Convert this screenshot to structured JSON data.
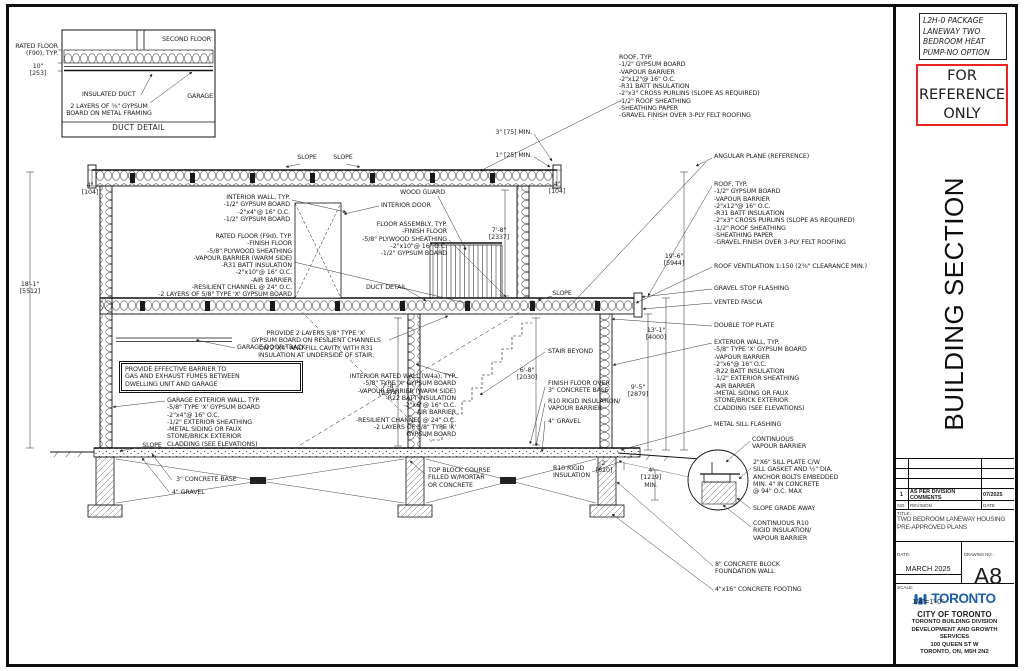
{
  "panel": {
    "package_lines": [
      "L2H-0 PACKAGE",
      "LANEWAY TWO",
      "BEDROOM HEAT",
      "PUMP-NO OPTION"
    ],
    "reference_lines": [
      "FOR",
      "REFERENCE",
      "ONLY"
    ],
    "section_title": "BUILDING SECTION",
    "revision_row": {
      "no": "1",
      "desc": "AS PER DIVISION COMMENTS",
      "date": "07/2025"
    },
    "revision_header": {
      "no": "NO.",
      "desc": "REVISION",
      "date": "DATE"
    },
    "title_label": "TITLE:",
    "title_text": "TWO BEDROOM LANEWAY HOUSING\nPRE-APPROVED PLANS",
    "date_label": "DATE:",
    "date_value": "MARCH 2025",
    "scale_label": "SCALE:",
    "scale_value": "1/4\"=1'-0\"",
    "drawing_no_label": "DRAWING NO.:",
    "drawing_no": "A8",
    "logo_text": "TORONTO",
    "org_lines": [
      "CITY OF TORONTO",
      "TORONTO BUILDING DIVISION",
      "DEVELOPMENT AND GROWTH",
      "SERVICES",
      "100 QUEEN ST W",
      "TORONTO, ON, M5H 2N2"
    ]
  },
  "colors": {
    "reference_red": "#e8251f",
    "toronto_blue": "#1b5faa",
    "ink": "#1a1a1a"
  },
  "duct_detail": {
    "second_floor": "SECOND FLOOR",
    "rated_floor": "RATED FLOOR\n(F90), TYP.",
    "dim_10": "10\"\n[253]",
    "insulated_duct": "INSULATED DUCT",
    "two_layers": "2 LAYERS OF ⅝\" GYPSUM\nBOARD ON METAL FRAMING",
    "garage": "GARAGE",
    "caption": "DUCT DETAIL"
  },
  "ann": {
    "interior_wall": "INTERIOR WALL, TYP.\n-1/2\" GYPSUM BOARD\n-2\"x4\"@ 16\" O.C.\n-1/2\" GYPSUM BOARD",
    "rated_floor": "RATED FLOOR (F9d), TYP.\n-FINISH FLOOR\n-5/8\" PLYWOOD SHEATHING\n-VAPOUR BARRIER (WARM SIDE)\n-R31 BATT INSULATION\n-2\"x10\"@ 16\" O.C.\n-AIR BARRIER\n-RESILIENT CHANNEL @ 24\" O.C.\n-2 LAYERS OF 5/8\" TYPE 'X' GYPSUM BOARD",
    "dim_18_1": "18'-1\"\n[5512]",
    "garage_door_track": "GARAGE DOOR TRACK",
    "barrier_note": "PROVIDE EFFECTIVE BARRIER TO\nGAS AND EXHAUST FUMES BETWEEN\nDWELLING UNIT AND GARAGE",
    "garage_ext_wall": "GARAGE EXTERIOR WALL, TYP.\n-5/8\" TYPE 'X' GYPSUM BOARD\n-2\"x4\"@ 16\" O.C.\n-1/2\" EXTERIOR SHEATHING\n-METAL SIDING OR FAUX\nSTONE/BRICK EXTERIOR\nCLADDING (SEE ELEVATIONS)",
    "slope": "SLOPE",
    "concrete_base_3": "3\" CONCRETE BASE",
    "gravel_4": "4\" GRAVEL",
    "wood_guard": "WOOD GUARD",
    "interior_door": "INTERIOR DOOR",
    "floor_assembly": "FLOOR ASSEMBLY, TYP.\n-FINISH FLOOR\n-5/8\" PLYWOOD SHEATHING\n-2\"x10\"@ 16\" O.C.\n-1/2\" GYPSUM BOARD",
    "duct_detail_ref": "DUCT DETAIL",
    "provide_2_layers": "PROVIDE 2 LAYERS 5/8\" TYPE 'X'\nGYPSUM BOARD ON RESILIENT CHANNELS\nON 2\"X4\" AND FILL CAVITY WITH R31\nINSULATION AT UNDERSIDE OF STAIR.",
    "interior_rated_wall": "INTERIOR RATED WALL (W4a), TYP.\n-5/8\" TYPE 'X' GYPSUM BOARD\n-VAPOUR BARRIER (WARM SIDE)\n-R22 BATT INSULATION\n-2\"x6\"@ 16\" O.C.\n-AIR BARRIER\n-RESILIENT CHANNEL @ 24\" O.C.\n-2 LAYERS OF 5/8\" TYPE 'X'\nGYPSUM BOARD",
    "stair_beyond": "STAIR BEYOND",
    "dim_6_8": "6'-8\"\n[2030]",
    "dim_7_8_upper": "7'-8\"\n[2337]",
    "dim_7_8_lower": "7'-8\"\n[2374]",
    "finish_floor_over": "FINISH FLOOR OVER\n3\" CONCRETE BASE",
    "r10_rigid_vb": "R10 RIGID INSULATION/\nVAPOUR BARRIER",
    "top_block": "TOP BLOCK COURSE\nFILLED W/MORTAR\nOR CONCRETE",
    "r10_rigid": "R10 RIGID\nINSULATION",
    "dim_2ft": "2'\n[610]",
    "dim_4ft": "4'\n[1219]\nMIN.",
    "roof_typ": "ROOF, TYP.\n-1/2\" GYPSUM BOARD\n-VAPOUR BARRIER\n-2\"x12\"@ 16\" O.C.\n-R31 BATT INSULATION\n-2\"x3\" CROSS PURLINS (SLOPE AS REQUIRED)\n-1/2\" ROOF SHEATHING\n-SHEATHING PAPER\n-GRAVEL FINISH OVER 3-PLY FELT ROOFING",
    "angular_plane": "ANGULAR PLANE (REFERENCE)",
    "roof_vent": "ROOF VENTILATION 1:150 (2⅜\" CLEARANCE MIN.)",
    "gravel_stop": "GRAVEL STOP FLASHING",
    "vented_fascia": "VENTED FASCIA",
    "double_top_plate": "DOUBLE TOP PLATE",
    "ext_wall": "EXTERIOR WALL, TYP.\n-5/8\" TYPE 'X' GYPSUM BOARD\n-VAPOUR BARRIER\n-2\"x6\"@ 16\" O.C.\n-R22 BATT INSULATION\n-1/2\" EXTERIOR SHEATHING\n-AIR BARRIER\n-METAL SIDING OR FAUX\nSTONE/BRICK EXTERIOR\nCLADDING (SEE ELEVATIONS)",
    "metal_sill": "METAL SILL FLASHING",
    "cont_vb": "CONTINUOUS\nVAPOUR BARRIER",
    "sill_plate": "2\"X6\" SILL PLATE C/W\nSILL GASKET AND ½\" DIA.\nANCHOR BOLTS EMBEDDED\nMIN. 4\" IN CONCRETE\n@ 94\" O.C. MAX",
    "slope_grade": "SLOPE GRADE AWAY",
    "cont_r10": "CONTINUOUS R10\nRIGID INSULATION/\nVAPOUR BARRIER",
    "conc_block": "8\" CONCRETE BLOCK\nFOUNDATION WALL",
    "conc_footing": "4\"x16\" CONCRETE FOOTING",
    "dim_19_6": "19'-6\"\n[5944]",
    "dim_13_1": "13'-1\"\n[4000]",
    "dim_9_5": "9'-5\"\n[2879]",
    "dim_4in": "4\"\n[104]",
    "dim_75min": "3\" [75] MIN.",
    "dim_25min": "1\" [25] MIN."
  }
}
